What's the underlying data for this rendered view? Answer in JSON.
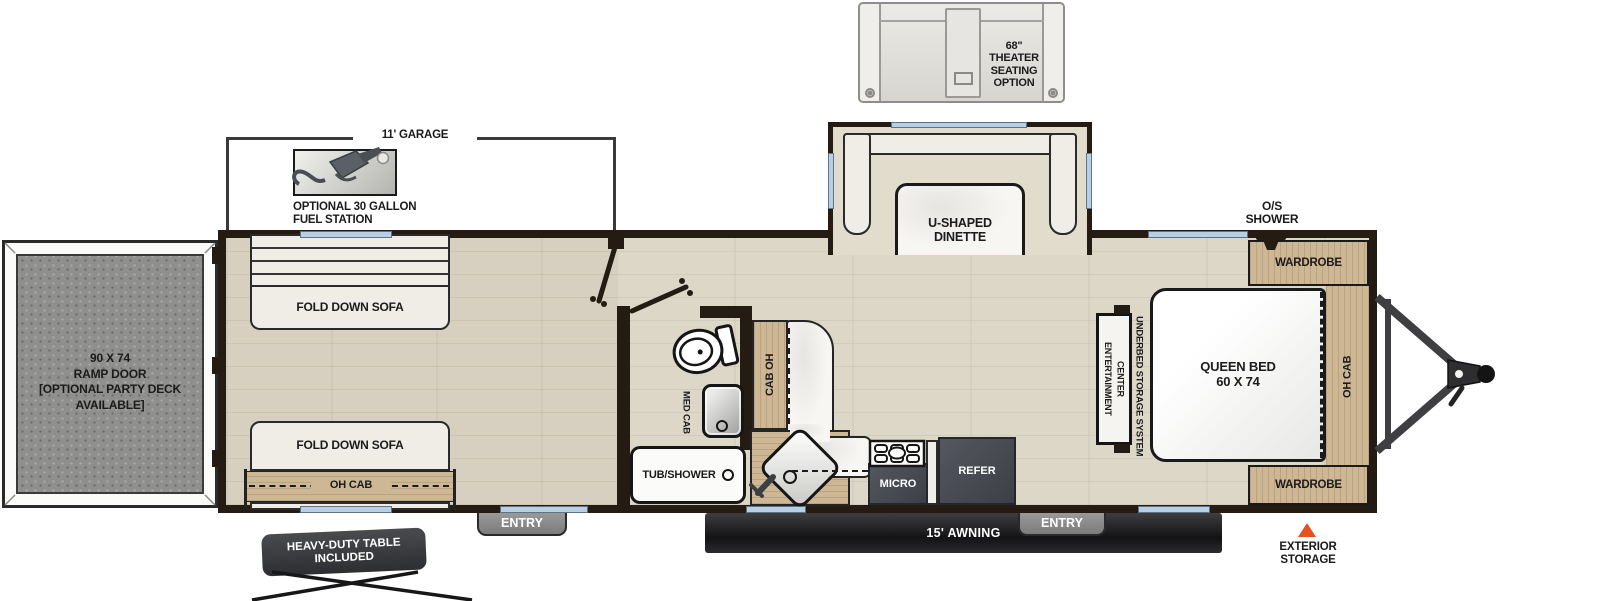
{
  "colors": {
    "wall": "#241b12",
    "window": "#b9cfe6",
    "wood": "#cdb795",
    "floor": "#d7d0c0",
    "ramp_door_gray": "#8f908e",
    "appliance_dark": "#464a50",
    "awning_black": "#1d1d1f",
    "storage_triangle_orange": "#e8511f"
  },
  "ext": {
    "theater": "68\"\nTHEATER\nSEATING\nOPTION",
    "garage_dim": "11' GARAGE",
    "fuel": "OPTIONAL 30 GALLON\nFUEL STATION",
    "awning": "15' AWNING",
    "table": "HEAVY-DUTY TABLE\nINCLUDED",
    "storage": "EXTERIOR\nSTORAGE",
    "entry_left": "ENTRY",
    "entry_right": "ENTRY",
    "os_shower": "O/S\nSHOWER"
  },
  "garage": {
    "ramp": "90 X 74\nRAMP DOOR\n[OPTIONAL PARTY DECK\nAVAILABLE]",
    "sofa1": "FOLD DOWN SOFA",
    "sofa2": "FOLD DOWN SOFA",
    "ohcab": "OH CAB"
  },
  "bath": {
    "medcab": "MED CAB",
    "tub": "TUB/SHOWER"
  },
  "kitchen": {
    "caboh": "CAB OH",
    "micro": "MICRO",
    "refer": "REFER"
  },
  "dinette": {
    "label": "U-SHAPED\nDINETTE"
  },
  "bed": {
    "queen": "QUEEN BED\n60 X 74",
    "underbed": "UNDERBED STORAGE SYSTEM",
    "ent": "ENTERTAINMENT\nCENTER",
    "ohcab": "OH CAB",
    "ward1": "WARDROBE",
    "ward2": "WARDROBE"
  }
}
